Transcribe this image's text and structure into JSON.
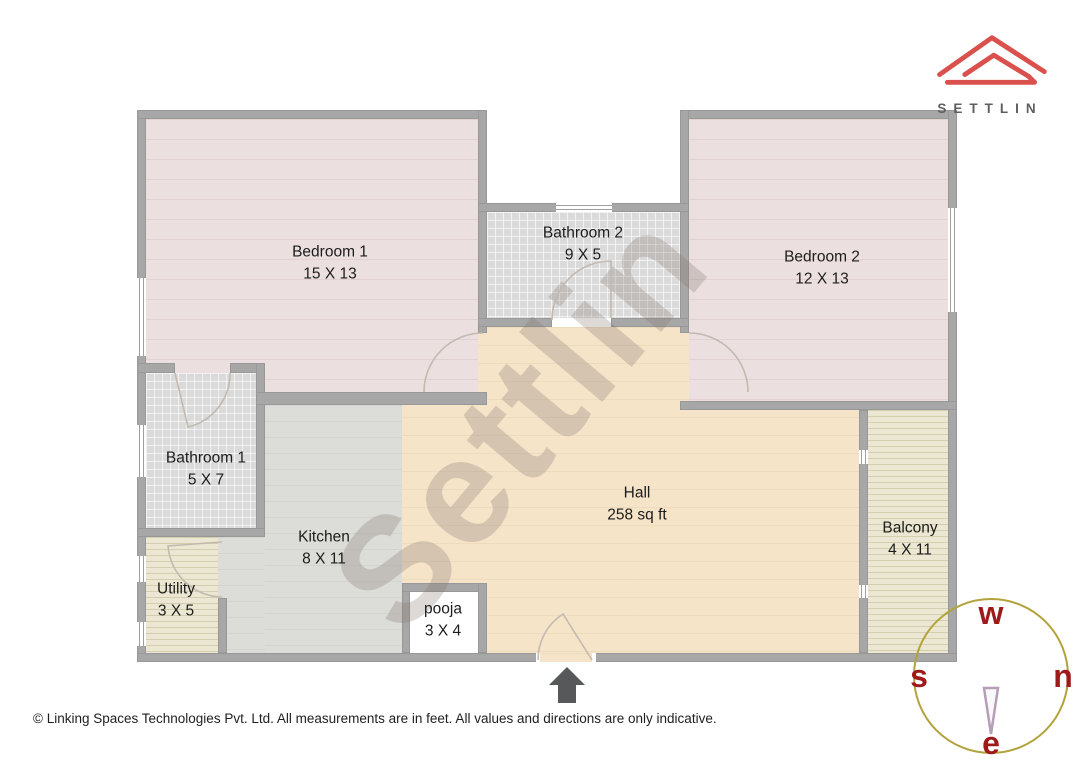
{
  "brand": {
    "name": "SETTLIN"
  },
  "watermark": {
    "text": "Settlin"
  },
  "rooms": [
    {
      "name": "Bedroom 1",
      "dims": "15 X 13"
    },
    {
      "name": "Bathroom 2",
      "dims": "9 X 5"
    },
    {
      "name": "Bedroom 2",
      "dims": "12 X 13"
    },
    {
      "name": "Bathroom 1",
      "dims": "5 X 7"
    },
    {
      "name": "Kitchen",
      "dims": "8 X 11"
    },
    {
      "name": "Utility",
      "dims": "3 X 5"
    },
    {
      "name": "pooja",
      "dims": "3 X 4"
    },
    {
      "name": "Hall",
      "dims": "258 sq ft"
    },
    {
      "name": "Balcony",
      "dims": "4 X 11"
    }
  ],
  "compass": {
    "top": "w",
    "right": "n",
    "left": "s",
    "bottom": "e"
  },
  "footer": {
    "text": "© Linking Spaces Technologies Pvt. Ltd. All measurements are in feet. All values and directions are only indicative."
  },
  "colors": {
    "brand_red": "#d9504c",
    "compass_ring": "#b3a33b",
    "compass_letters": "#9e1a1a",
    "wall_gray": "#a7a7a7",
    "hall_beige": "#f6e4c9",
    "bedroom_pink": "#ecdfdf"
  }
}
